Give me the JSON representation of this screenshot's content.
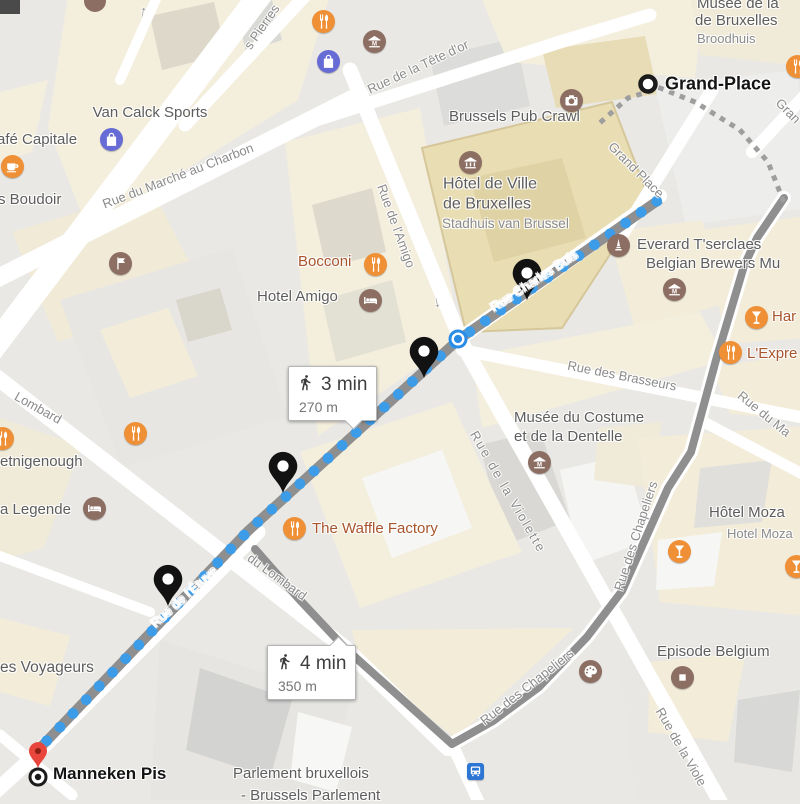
{
  "map": {
    "markers": {
      "start": {
        "label": "Grand-Place",
        "x": 648,
        "y": 84
      },
      "end": {
        "label": "Manneken Pis",
        "x": 38,
        "y": 777
      }
    },
    "route": {
      "main": {
        "waypoints": [
          [
            660,
            199
          ],
          [
            458,
            340
          ],
          [
            248,
            531
          ],
          [
            36,
            752
          ]
        ],
        "dot_spacing": 19,
        "dot_radius": 5.4
      },
      "alt": {
        "waypoints": [
          [
            784,
            198
          ],
          [
            757,
            238
          ],
          [
            744,
            266
          ],
          [
            716,
            360
          ],
          [
            691,
            452
          ],
          [
            668,
            488
          ],
          [
            622,
            591
          ],
          [
            587,
            637
          ],
          [
            539,
            687
          ],
          [
            493,
            721
          ],
          [
            452,
            744
          ],
          [
            345,
            648
          ],
          [
            298,
            598
          ],
          [
            255,
            549
          ]
        ]
      },
      "connector_dashed": [
        [
          602,
          121
        ],
        [
          628,
          98
        ],
        [
          660,
          88
        ],
        [
          695,
          102
        ],
        [
          740,
          130
        ],
        [
          768,
          162
        ],
        [
          783,
          200
        ]
      ],
      "black_pins": [
        [
          527,
          300
        ],
        [
          424,
          378
        ],
        [
          283,
          493
        ],
        [
          168,
          606
        ]
      ],
      "red_pin": [
        38,
        768
      ],
      "stop_dot": [
        458,
        339
      ]
    },
    "badges": [
      {
        "time": "3 min",
        "distance": "270 m",
        "x": 288,
        "y": 366,
        "pointer": "bottom"
      },
      {
        "time": "4 min",
        "distance": "350 m",
        "x": 267,
        "y": 645,
        "pointer": "top-right"
      }
    ],
    "pois": [
      {
        "type": "restaurant",
        "x": 323,
        "y": 21
      },
      {
        "type": "shopping",
        "x": 328,
        "y": 61
      },
      {
        "type": "museum_m",
        "x": 374,
        "y": 41
      },
      {
        "type": "shopping",
        "x": 111,
        "y": 139
      },
      {
        "type": "coffee",
        "x": 12,
        "y": 166
      },
      {
        "type": "restaurant",
        "x": 797,
        "y": 66
      },
      {
        "type": "camera",
        "x": 571,
        "y": 100
      },
      {
        "type": "museum_col",
        "x": 470,
        "y": 162
      },
      {
        "type": "monument",
        "x": 618,
        "y": 245
      },
      {
        "type": "museum_m",
        "x": 674,
        "y": 289
      },
      {
        "type": "restaurant",
        "x": 375,
        "y": 264
      },
      {
        "type": "bed",
        "x": 370,
        "y": 300
      },
      {
        "type": "bar",
        "x": 756,
        "y": 317
      },
      {
        "type": "restaurant",
        "x": 730,
        "y": 352
      },
      {
        "type": "attraction",
        "x": 120,
        "y": 263
      },
      {
        "type": "restaurant",
        "x": 135,
        "y": 433
      },
      {
        "type": "restaurant",
        "x": 2,
        "y": 438
      },
      {
        "type": "bed",
        "x": 94,
        "y": 508
      },
      {
        "type": "museum_m",
        "x": 539,
        "y": 462
      },
      {
        "type": "restaurant",
        "x": 294,
        "y": 528
      },
      {
        "type": "bar",
        "x": 679,
        "y": 551
      },
      {
        "type": "bar",
        "x": 796,
        "y": 566
      },
      {
        "type": "palette",
        "x": 590,
        "y": 671
      },
      {
        "type": "store",
        "x": 682,
        "y": 677
      },
      {
        "type": "transit-stop",
        "x": 458,
        "y": 339
      },
      {
        "type": "bus-station",
        "x": 475,
        "y": 771
      }
    ],
    "labels": [
      {
        "text": "Musée de la",
        "x": 697,
        "y": 4,
        "anchor": "start",
        "cls": "poi",
        "size": 15
      },
      {
        "text": "de Bruxelles",
        "x": 695,
        "y": 21,
        "anchor": "start",
        "cls": "poi",
        "size": 15
      },
      {
        "text": "Broodhuis",
        "x": 697,
        "y": 39,
        "anchor": "start",
        "cls": "poi-muted",
        "size": 13
      },
      {
        "text": "Van Calck Sports",
        "x": 150,
        "y": 113,
        "cls": "poi",
        "size": 15
      },
      {
        "text": "afé Capitale",
        "x": -3,
        "y": 140,
        "anchor": "start",
        "cls": "poi",
        "size": 15
      },
      {
        "text": "s Boudoir",
        "x": -2,
        "y": 200,
        "anchor": "start",
        "cls": "poi",
        "size": 15
      },
      {
        "text": "Brussels Pub Crawl",
        "x": 449,
        "y": 117,
        "anchor": "start",
        "cls": "poi",
        "size": 15
      },
      {
        "text": "Hôtel de Ville",
        "x": 443,
        "y": 185,
        "anchor": "start",
        "cls": "poi",
        "size": 16
      },
      {
        "text": "de Bruxelles",
        "x": 443,
        "y": 205,
        "anchor": "start",
        "cls": "poi",
        "size": 16
      },
      {
        "text": "Stadhuis van Brussel",
        "x": 442,
        "y": 224,
        "anchor": "start",
        "cls": "poi-muted",
        "size": 13.5
      },
      {
        "text": "Everard T'serclaes",
        "x": 637,
        "y": 245,
        "anchor": "start",
        "cls": "poi",
        "size": 15
      },
      {
        "text": "Belgian Brewers Mu",
        "x": 646,
        "y": 264,
        "anchor": "start",
        "cls": "poi",
        "size": 15
      },
      {
        "text": "Bocconi",
        "x": 298,
        "y": 262,
        "anchor": "start",
        "cls": "poi-food",
        "size": 15
      },
      {
        "text": "Hotel Amigo",
        "x": 257,
        "y": 297,
        "anchor": "start",
        "cls": "poi",
        "size": 15
      },
      {
        "text": "Har",
        "x": 772,
        "y": 317,
        "anchor": "start",
        "cls": "poi-food",
        "size": 15
      },
      {
        "text": "L'Expre",
        "x": 747,
        "y": 354,
        "anchor": "start",
        "cls": "poi-food",
        "size": 15
      },
      {
        "text": "Musée du Costume",
        "x": 514,
        "y": 418,
        "anchor": "start",
        "cls": "poi",
        "size": 15
      },
      {
        "text": "et de la Dentelle",
        "x": 514,
        "y": 437,
        "anchor": "start",
        "cls": "poi",
        "size": 15
      },
      {
        "text": "The Waffle Factory",
        "x": 312,
        "y": 529,
        "anchor": "start",
        "cls": "poi-food",
        "size": 15
      },
      {
        "text": "Hôtel Moza",
        "x": 709,
        "y": 513,
        "anchor": "start",
        "cls": "poi",
        "size": 15
      },
      {
        "text": "Hotel Moza",
        "x": 727,
        "y": 534,
        "anchor": "start",
        "cls": "poi-muted",
        "size": 13
      },
      {
        "text": "Episode Belgium",
        "x": 657,
        "y": 652,
        "anchor": "start",
        "cls": "poi",
        "size": 15
      },
      {
        "text": "etnigenough",
        "x": 0,
        "y": 462,
        "anchor": "start",
        "cls": "poi",
        "size": 15
      },
      {
        "text": "a Legende",
        "x": 0,
        "y": 510,
        "anchor": "start",
        "cls": "poi",
        "size": 15
      },
      {
        "text": "es Voyageurs",
        "x": 0,
        "y": 668,
        "anchor": "start",
        "cls": "poi",
        "size": 15.5
      },
      {
        "text": "Parlement bruxellois",
        "x": 233,
        "y": 774,
        "anchor": "start",
        "cls": "poi",
        "size": 15
      },
      {
        "text": "- Brussels Parlement",
        "x": 241,
        "y": 796,
        "anchor": "start",
        "cls": "poi",
        "size": 15
      },
      {
        "text": "Grand-Place",
        "x": 665,
        "y": 84,
        "anchor": "start",
        "cls": "place",
        "size": 18
      },
      {
        "text": "Manneken Pis",
        "x": 53,
        "y": 774,
        "anchor": "start",
        "cls": "place",
        "size": 17
      },
      {
        "text": "s Pierres",
        "x": 262,
        "y": 27,
        "rot": -55,
        "cls": "street"
      },
      {
        "text": "Rue du Marché au Charbon",
        "x": 178,
        "y": 176,
        "rot": -21,
        "cls": "street"
      },
      {
        "text": "Rue de la Tête d'or",
        "x": 418,
        "y": 67,
        "rot": -25,
        "cls": "street"
      },
      {
        "text": "Rue de l'Amigo",
        "x": 396,
        "y": 226,
        "rot": 70,
        "cls": "street"
      },
      {
        "text": "Grand Place",
        "x": 636,
        "y": 170,
        "rot": 45,
        "cls": "street"
      },
      {
        "text": "Gran",
        "x": 788,
        "y": 111,
        "rot": 45,
        "cls": "street"
      },
      {
        "text": "Rue Charles Buls",
        "x": 534,
        "y": 281,
        "rot": -33,
        "cls": "street-white"
      },
      {
        "text": "Rue des Brasseurs",
        "x": 622,
        "y": 376,
        "rot": 11,
        "cls": "street"
      },
      {
        "text": "Rue de la Violette",
        "x": 508,
        "y": 492,
        "rot": 60,
        "cls": "street",
        "ls": 2
      },
      {
        "text": "Rue de la Viole",
        "x": 681,
        "y": 747,
        "rot": 60,
        "cls": "street"
      },
      {
        "text": "Rue du Ma",
        "x": 764,
        "y": 414,
        "rot": 39,
        "cls": "street"
      },
      {
        "text": "Rue des Chapeliers",
        "x": 527,
        "y": 687,
        "rot": -38,
        "cls": "street"
      },
      {
        "text": "Rue des Chapeliers",
        "x": 636,
        "y": 536,
        "rot": -72,
        "cls": "street"
      },
      {
        "text": "Rue de l'Étuve",
        "x": 184,
        "y": 597,
        "rot": -42,
        "cls": "street-white"
      },
      {
        "text": "Lombard",
        "x": 38,
        "y": 408,
        "rot": 29,
        "cls": "street"
      },
      {
        "text": "du Lombard",
        "x": 277,
        "y": 577,
        "rot": 36,
        "cls": "street"
      },
      {
        "text": "↑",
        "x": 143,
        "y": 12,
        "rot": 12,
        "cls": "arrow"
      },
      {
        "text": "↑",
        "x": 437,
        "y": 303,
        "rot": 168,
        "cls": "arrow"
      }
    ],
    "colors": {
      "route_dot_blue": "#3d9ce8",
      "route_gray": "#8f8f8f",
      "connector_gray": "#9e9e9e",
      "poi_orange": "#ef9036",
      "poi_brown": "#8d6e63",
      "poi_indigo": "#666bd6",
      "transit_blue": "#2e76d3",
      "pin_black": "#121212",
      "pin_red": "#e8453c"
    }
  }
}
